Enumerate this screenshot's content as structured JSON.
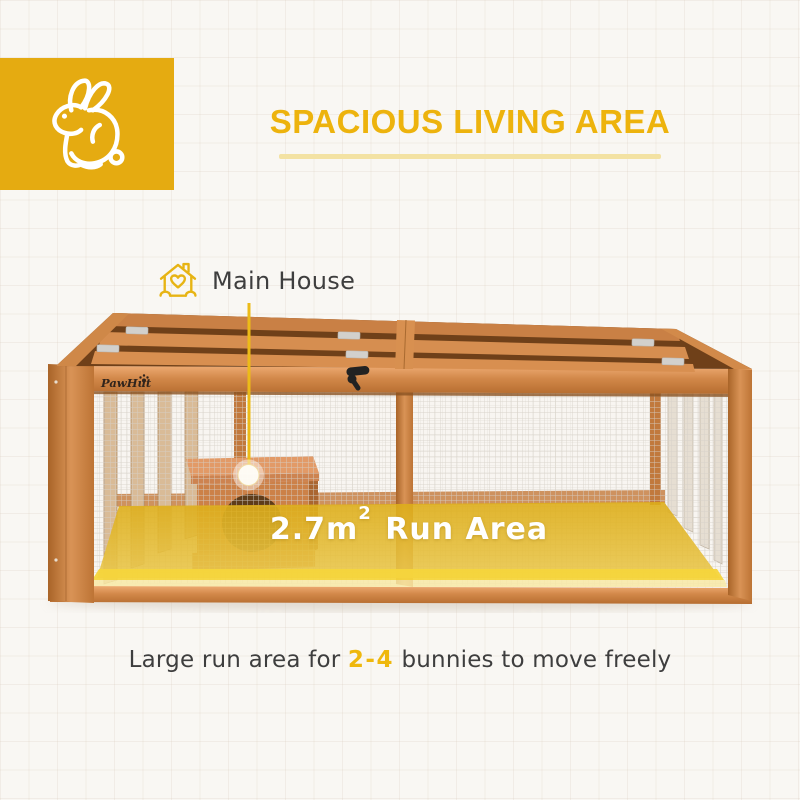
{
  "badge": {
    "icon": "rabbit",
    "color": "#E5AB11"
  },
  "header": {
    "title": "SPACIOUS LIVING AREA"
  },
  "callout": {
    "label": "Main House",
    "icon": "house-with-heart"
  },
  "hutch": {
    "brand": "PawHut",
    "area": {
      "value": "2.7m",
      "sup": "2",
      "suffix": " Run Area"
    }
  },
  "caption": {
    "prefix": "Large run area for ",
    "highlight": "2-4",
    "suffix": " bunnies to move freely"
  },
  "colors": {
    "brand_yellow": "#E5AB11",
    "title_yellow": "#EDB30D",
    "underline_yellow": "#F3E2A3",
    "overlay_yellow": "#E2B51C",
    "overlay_bright_yellow": "#F5D53C",
    "wood": "#D28849",
    "text_dark": "#3E3E3E",
    "background": "#F9F7F3"
  }
}
